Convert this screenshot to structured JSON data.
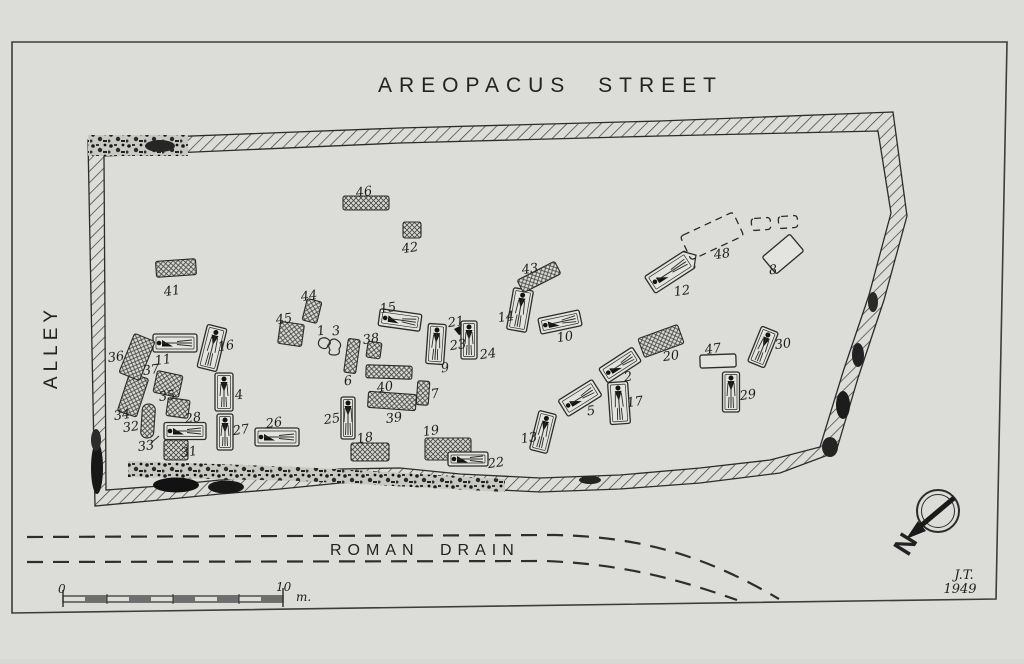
{
  "title": "AREOPACUS STREET",
  "side_label": "ALLEY",
  "drain_label": "ROMAN DRAIN",
  "north_label": "N",
  "signature_initials": "J.T.",
  "signature_year": "1949",
  "scale": {
    "start": "0",
    "end": "10",
    "unit": "m."
  },
  "colors": {
    "paper": "#dcdcd8",
    "ink": "#2b2b2b",
    "grave_fill": "#e3e3df",
    "dark": "#141414"
  },
  "plan": {
    "features": [
      {
        "label": "1",
        "type": "pot1",
        "x": 325,
        "y": 344,
        "rot": 0,
        "lx": -4,
        "ly": -13
      },
      {
        "label": "2",
        "type": "grave_h",
        "x": 620,
        "y": 365,
        "w": 40,
        "h": 17,
        "rot": -33,
        "lx": 8,
        "ly": 12
      },
      {
        "label": "3",
        "type": "pot3",
        "x": 335,
        "y": 347,
        "rot": 0,
        "lx": 1,
        "ly": -16
      },
      {
        "label": "4",
        "type": "grave_v",
        "x": 224,
        "y": 392,
        "w": 18,
        "h": 38,
        "rot": 0,
        "lx": 15,
        "ly": 3
      },
      {
        "label": "5",
        "type": "grave_h",
        "x": 580,
        "y": 398,
        "w": 40,
        "h": 19,
        "rot": -32,
        "lx": 11,
        "ly": 13
      },
      {
        "label": "6",
        "type": "crosshatch",
        "x": 352,
        "y": 356,
        "w": 12,
        "h": 34,
        "rot": 8,
        "lx": -4,
        "ly": 25
      },
      {
        "label": "7",
        "type": "crosshatch",
        "x": 423,
        "y": 393,
        "w": 12,
        "h": 24,
        "rot": 4,
        "lx": 12,
        "ly": 1
      },
      {
        "label": "8",
        "type": "plain",
        "x": 783,
        "y": 254,
        "w": 36,
        "h": 22,
        "rot": -40,
        "lx": -10,
        "ly": 16
      },
      {
        "label": "9",
        "type": "grave_v",
        "x": 436,
        "y": 344,
        "w": 18,
        "h": 40,
        "rot": 4,
        "lx": 9,
        "ly": 24
      },
      {
        "label": "10",
        "type": "grave_h",
        "x": 560,
        "y": 322,
        "w": 42,
        "h": 16,
        "rot": -12,
        "lx": 5,
        "ly": 15
      },
      {
        "label": "11",
        "type": "grave_h",
        "x": 175,
        "y": 343,
        "w": 44,
        "h": 18,
        "rot": 0,
        "lx": -12,
        "ly": 17
      },
      {
        "label": "12",
        "type": "grave_h",
        "x": 670,
        "y": 272,
        "w": 48,
        "h": 20,
        "rot": -33,
        "lx": 12,
        "ly": 19,
        "pointed": true
      },
      {
        "label": "13",
        "type": "grave_v",
        "x": 543,
        "y": 432,
        "w": 18,
        "h": 40,
        "rot": 14,
        "lx": -14,
        "ly": 6
      },
      {
        "label": "14",
        "type": "grave_v",
        "x": 520,
        "y": 310,
        "w": 20,
        "h": 42,
        "rot": 10,
        "lx": -14,
        "ly": 7
      },
      {
        "label": "15",
        "type": "grave_h",
        "x": 400,
        "y": 320,
        "w": 42,
        "h": 17,
        "rot": 8,
        "lx": -12,
        "ly": -12
      },
      {
        "label": "16",
        "type": "grave_v",
        "x": 212,
        "y": 348,
        "w": 20,
        "h": 44,
        "rot": 14,
        "lx": 14,
        "ly": -2
      },
      {
        "label": "17",
        "type": "grave_v",
        "x": 619,
        "y": 403,
        "w": 20,
        "h": 42,
        "rot": -4,
        "lx": 16,
        "ly": -1
      },
      {
        "label": "18",
        "type": "crosshatch",
        "x": 370,
        "y": 452,
        "w": 38,
        "h": 18,
        "rot": 0,
        "lx": -5,
        "ly": -14
      },
      {
        "label": "19",
        "type": "crosshatch",
        "x": 448,
        "y": 449,
        "w": 46,
        "h": 22,
        "rot": 0,
        "lx": -17,
        "ly": -18
      },
      {
        "label": "20",
        "type": "crosshatch",
        "x": 661,
        "y": 341,
        "w": 42,
        "h": 20,
        "rot": -20,
        "lx": 10,
        "ly": 15
      },
      {
        "label": "21",
        "type": "find",
        "x": 461,
        "y": 331,
        "rot": 0,
        "lx": -5,
        "ly": -9
      },
      {
        "label": "22",
        "type": "grave_h",
        "x": 468,
        "y": 459,
        "w": 40,
        "h": 14,
        "rot": 0,
        "lx": 28,
        "ly": 4
      },
      {
        "label": "23",
        "type": "label_only",
        "x": 458,
        "y": 345,
        "lx": 0,
        "ly": 0
      },
      {
        "label": "24",
        "type": "grave_v",
        "x": 469,
        "y": 340,
        "w": 16,
        "h": 38,
        "rot": 0,
        "lx": 19,
        "ly": 14
      },
      {
        "label": "25",
        "type": "grave_v",
        "x": 348,
        "y": 418,
        "w": 14,
        "h": 42,
        "rot": 0,
        "lx": -16,
        "ly": 1
      },
      {
        "label": "26",
        "type": "grave_h",
        "x": 277,
        "y": 437,
        "w": 44,
        "h": 18,
        "rot": 0,
        "lx": -3,
        "ly": -14
      },
      {
        "label": "27",
        "type": "grave_v",
        "x": 225,
        "y": 432,
        "w": 16,
        "h": 36,
        "rot": 0,
        "lx": 16,
        "ly": -2
      },
      {
        "label": "28",
        "type": "grave_h",
        "x": 185,
        "y": 431,
        "w": 42,
        "h": 17,
        "rot": 0,
        "lx": 8,
        "ly": -13
      },
      {
        "label": "29",
        "type": "grave_v",
        "x": 731,
        "y": 392,
        "w": 17,
        "h": 40,
        "rot": 0,
        "lx": 17,
        "ly": 3
      },
      {
        "label": "30",
        "type": "grave_v",
        "x": 763,
        "y": 347,
        "w": 18,
        "h": 38,
        "rot": 22,
        "lx": 20,
        "ly": -3
      },
      {
        "label": "31",
        "type": "crosshatch",
        "x": 176,
        "y": 450,
        "w": 24,
        "h": 20,
        "rot": 0,
        "lx": 13,
        "ly": 2
      },
      {
        "label": "32",
        "type": "bone",
        "x": 148,
        "y": 421,
        "w": 13,
        "h": 34,
        "rot": 4,
        "lx": -17,
        "ly": 6
      },
      {
        "label": "33",
        "type": "label_only",
        "x": 146,
        "y": 446,
        "lx": 0,
        "ly": 0,
        "arrow": [
          5,
          -3,
          13,
          -10
        ]
      },
      {
        "label": "34",
        "type": "crosshatch",
        "x": 133,
        "y": 395,
        "w": 20,
        "h": 40,
        "rot": 18,
        "lx": -11,
        "ly": 20
      },
      {
        "label": "35",
        "type": "crosshatch",
        "x": 178,
        "y": 408,
        "w": 22,
        "h": 18,
        "rot": 8,
        "lx": -11,
        "ly": -12
      },
      {
        "label": "36",
        "type": "crosshatch",
        "x": 137,
        "y": 357,
        "w": 22,
        "h": 42,
        "rot": 22,
        "lx": -21,
        "ly": 0
      },
      {
        "label": "37",
        "type": "crosshatch",
        "x": 168,
        "y": 384,
        "w": 26,
        "h": 22,
        "rot": 12,
        "lx": -17,
        "ly": -14
      },
      {
        "label": "38",
        "type": "crosshatch",
        "x": 374,
        "y": 350,
        "w": 14,
        "h": 16,
        "rot": 8,
        "lx": -3,
        "ly": -11
      },
      {
        "label": "39",
        "type": "crosshatch",
        "x": 392,
        "y": 401,
        "w": 48,
        "h": 16,
        "rot": 4,
        "lx": 2,
        "ly": 17
      },
      {
        "label": "40",
        "type": "crosshatch",
        "x": 389,
        "y": 372,
        "w": 46,
        "h": 13,
        "rot": 2,
        "lx": -4,
        "ly": 15
      },
      {
        "label": "41",
        "type": "crosshatch",
        "x": 176,
        "y": 268,
        "w": 40,
        "h": 16,
        "rot": -4,
        "lx": -4,
        "ly": 23
      },
      {
        "label": "42",
        "type": "crosshatch",
        "x": 412,
        "y": 230,
        "w": 18,
        "h": 16,
        "rot": 0,
        "lx": -2,
        "ly": 18
      },
      {
        "label": "43",
        "type": "crosshatch",
        "x": 539,
        "y": 277,
        "w": 42,
        "h": 14,
        "rot": -27,
        "lx": -9,
        "ly": -8
      },
      {
        "label": "44",
        "type": "crosshatch",
        "x": 312,
        "y": 311,
        "w": 15,
        "h": 22,
        "rot": 14,
        "lx": -3,
        "ly": -15
      },
      {
        "label": "45",
        "type": "crosshatch",
        "x": 291,
        "y": 334,
        "w": 24,
        "h": 22,
        "rot": 8,
        "lx": -7,
        "ly": -15
      },
      {
        "label": "46",
        "type": "crosshatch",
        "x": 366,
        "y": 203,
        "w": 46,
        "h": 14,
        "rot": 0,
        "lx": -2,
        "ly": -11
      },
      {
        "label": "47",
        "type": "plain",
        "x": 718,
        "y": 361,
        "w": 36,
        "h": 13,
        "rot": -2,
        "lx": -5,
        "ly": -12
      },
      {
        "label": "48",
        "type": "dashed",
        "x": 712,
        "y": 236,
        "w": 58,
        "h": 26,
        "rot": -25,
        "lx": 10,
        "ly": 18
      },
      {
        "label": "",
        "type": "dashed",
        "x": 761,
        "y": 224,
        "w": 19,
        "h": 12,
        "rot": -4,
        "lx": 0,
        "ly": 0
      },
      {
        "label": "",
        "type": "dashed",
        "x": 788,
        "y": 222,
        "w": 19,
        "h": 12,
        "rot": -4,
        "lx": 0,
        "ly": 0
      }
    ]
  }
}
